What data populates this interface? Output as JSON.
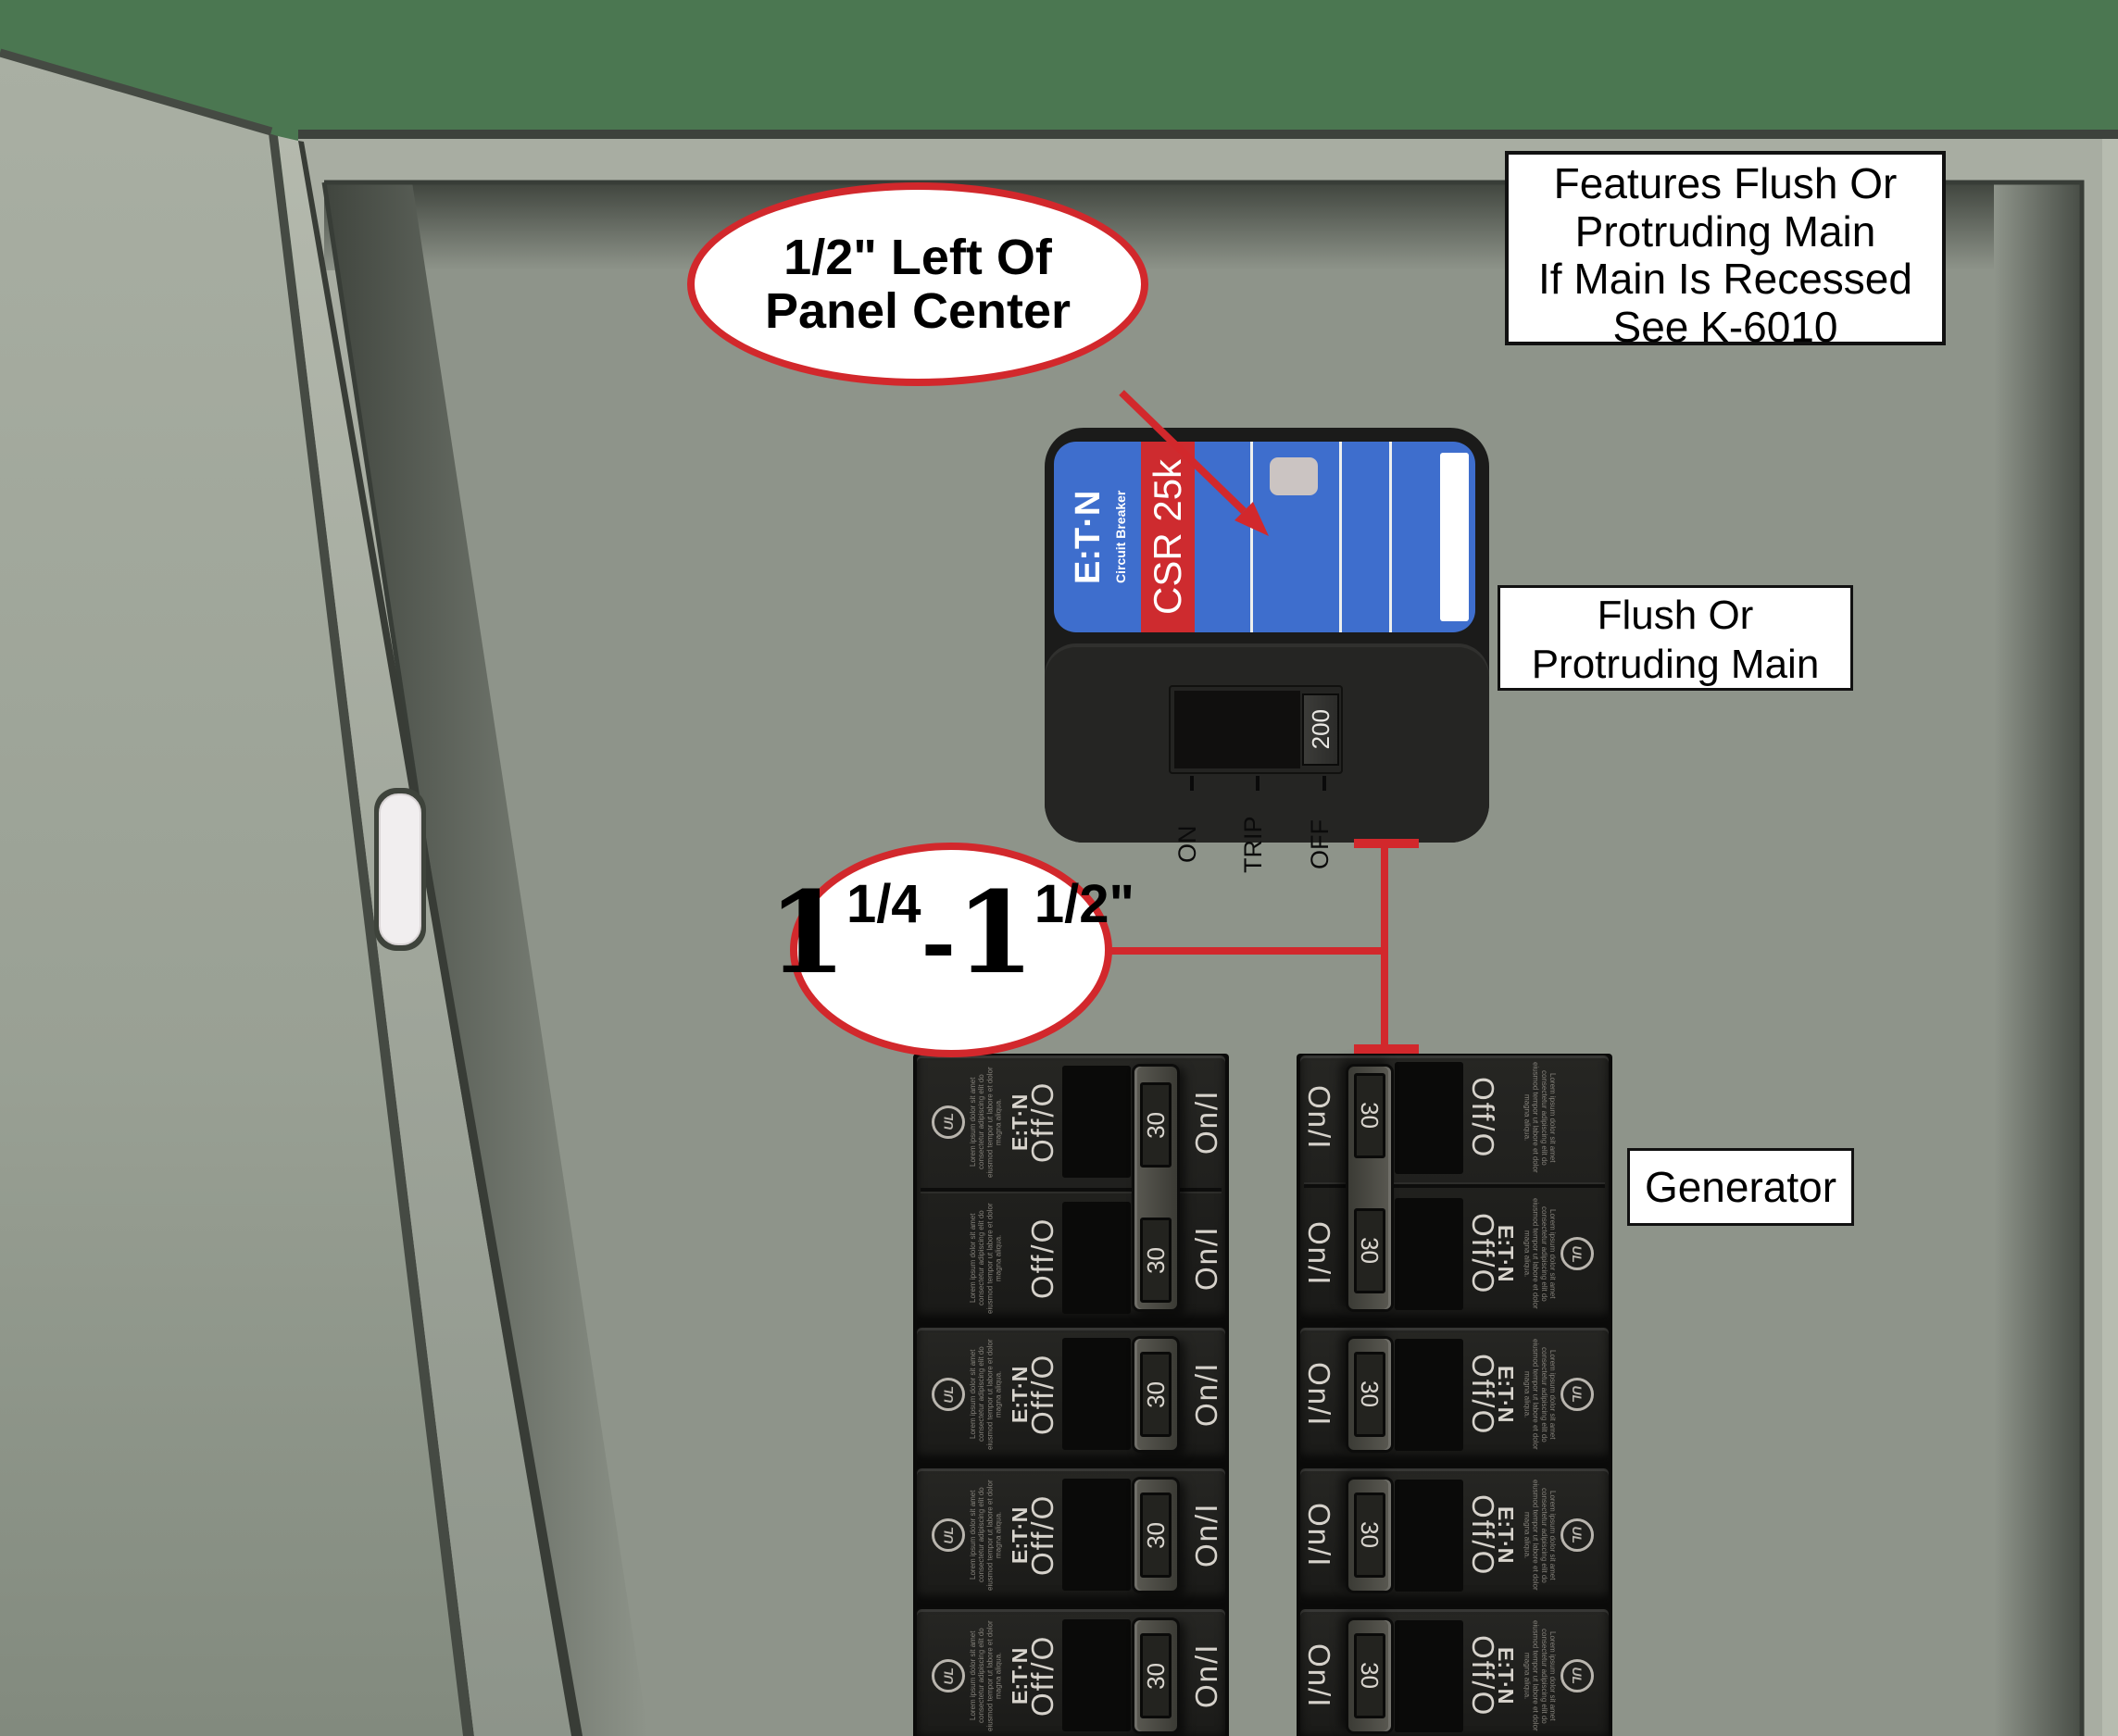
{
  "callout_half_inch": {
    "line1": "1/2\" Left Of",
    "line2": "Panel Center"
  },
  "callout_spacing": {
    "whole1": "1",
    "frac1": "1/4",
    "dash": "-",
    "whole2": "1",
    "frac2": "1/2",
    "unit": "\""
  },
  "note_features": {
    "lines": [
      "Features Flush Or",
      "Protruding Main",
      "If Main Is Recessed",
      "See K-6010"
    ]
  },
  "note_flush": {
    "lines": [
      "Flush Or",
      "Protruding Main"
    ]
  },
  "note_generator": {
    "text": "Generator"
  },
  "main_breaker": {
    "brand": "E:T·N",
    "brand_sub": "Circuit Breaker",
    "model": "CSR 25k",
    "rating": "200",
    "positions": [
      "ON",
      "TRIP",
      "OFF"
    ]
  },
  "branch_breakers": {
    "amp": "30",
    "off_label": "Off/O",
    "on_label": "On/I",
    "brand": "E:T·N",
    "ul": "UL",
    "fine_print": "Lorem ipsum dolor sit amet consectetur adipiscing elit do eiusmod tempor ut labore et dolor magna aliqua.",
    "left_column_rows": [
      2,
      1,
      1,
      1
    ],
    "right_column_rows": [
      2,
      1,
      1,
      1
    ]
  },
  "colors": {
    "background_green": "#4b7751",
    "panel_flange": "#a8ada2",
    "panel_interior": "#8e948a",
    "door_gray": "#a8aea2",
    "accent_red": "#d2282c",
    "label_blue": "#3e6ecd",
    "stripe_red": "#ce2b2f",
    "breaker_black": "#1b1b1a"
  }
}
